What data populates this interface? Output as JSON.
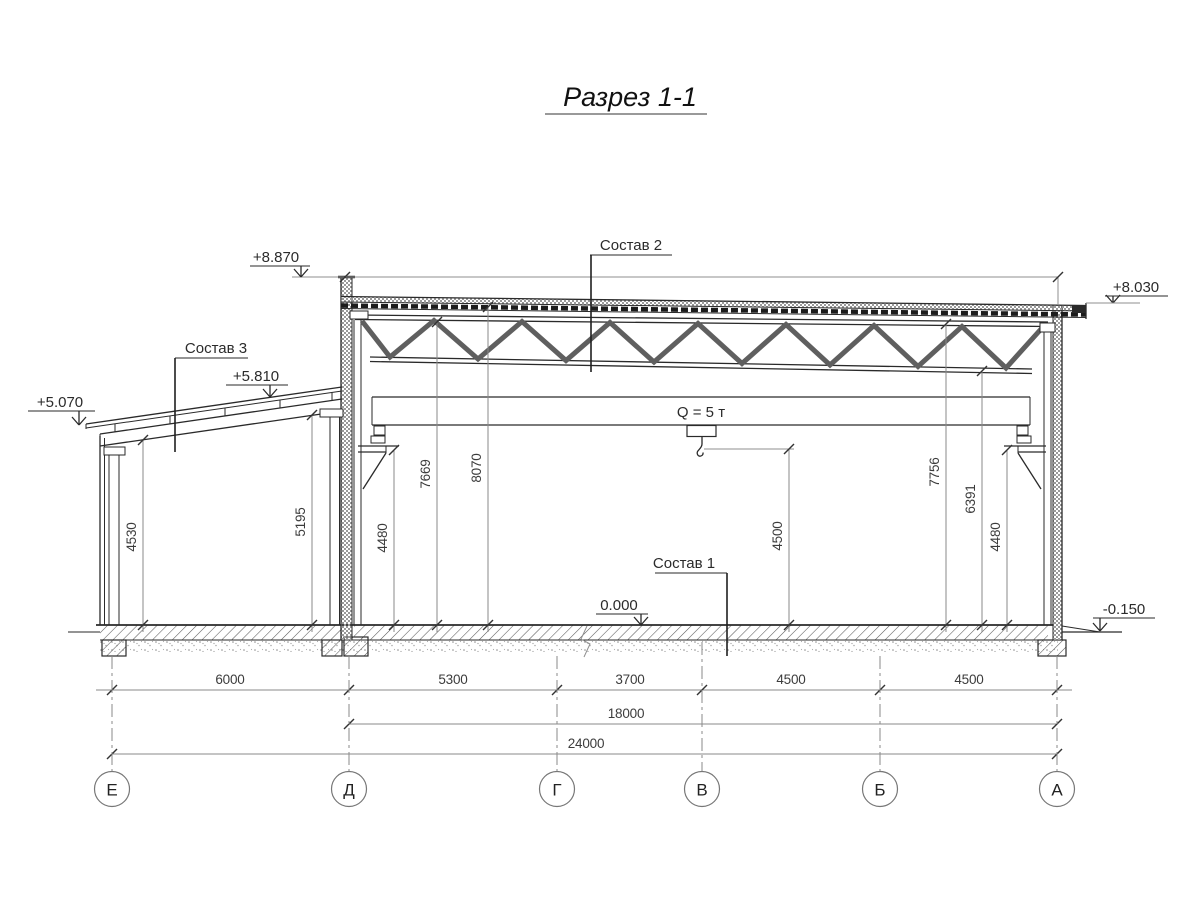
{
  "title": "Разрез 1-1",
  "crane_label": "Q = 5 т",
  "callouts": {
    "c1": "Состав 1",
    "c2": "Состав 2",
    "c3": "Состав 3"
  },
  "elevations": {
    "parapet": "+8.870",
    "roof_right": "+8.030",
    "annex_ridge": "+5.810",
    "annex_eave": "+5.070",
    "floor": "0.000",
    "ground": "-0.150"
  },
  "vertical_dims": {
    "annex_left": "4530",
    "annex_right": "5195",
    "crane_rail_left": "4480",
    "truss_left": "7669",
    "roof_left": "8070",
    "crane_hook": "4500",
    "truss_right_top": "7756",
    "truss_right_bottom": "6391",
    "crane_rail_right": "4480"
  },
  "span_dims": {
    "e_d": "6000",
    "d_g": "5300",
    "g_v": "3700",
    "v_b": "4500",
    "b_a": "4500",
    "hall_total": "18000",
    "overall": "24000"
  },
  "axes": {
    "e": "Е",
    "d": "Д",
    "g": "Г",
    "v": "В",
    "b": "Б",
    "a": "А"
  },
  "colors": {
    "line": "#2a2a2a",
    "dim_line": "#8a8a8a",
    "background": "#ffffff"
  }
}
